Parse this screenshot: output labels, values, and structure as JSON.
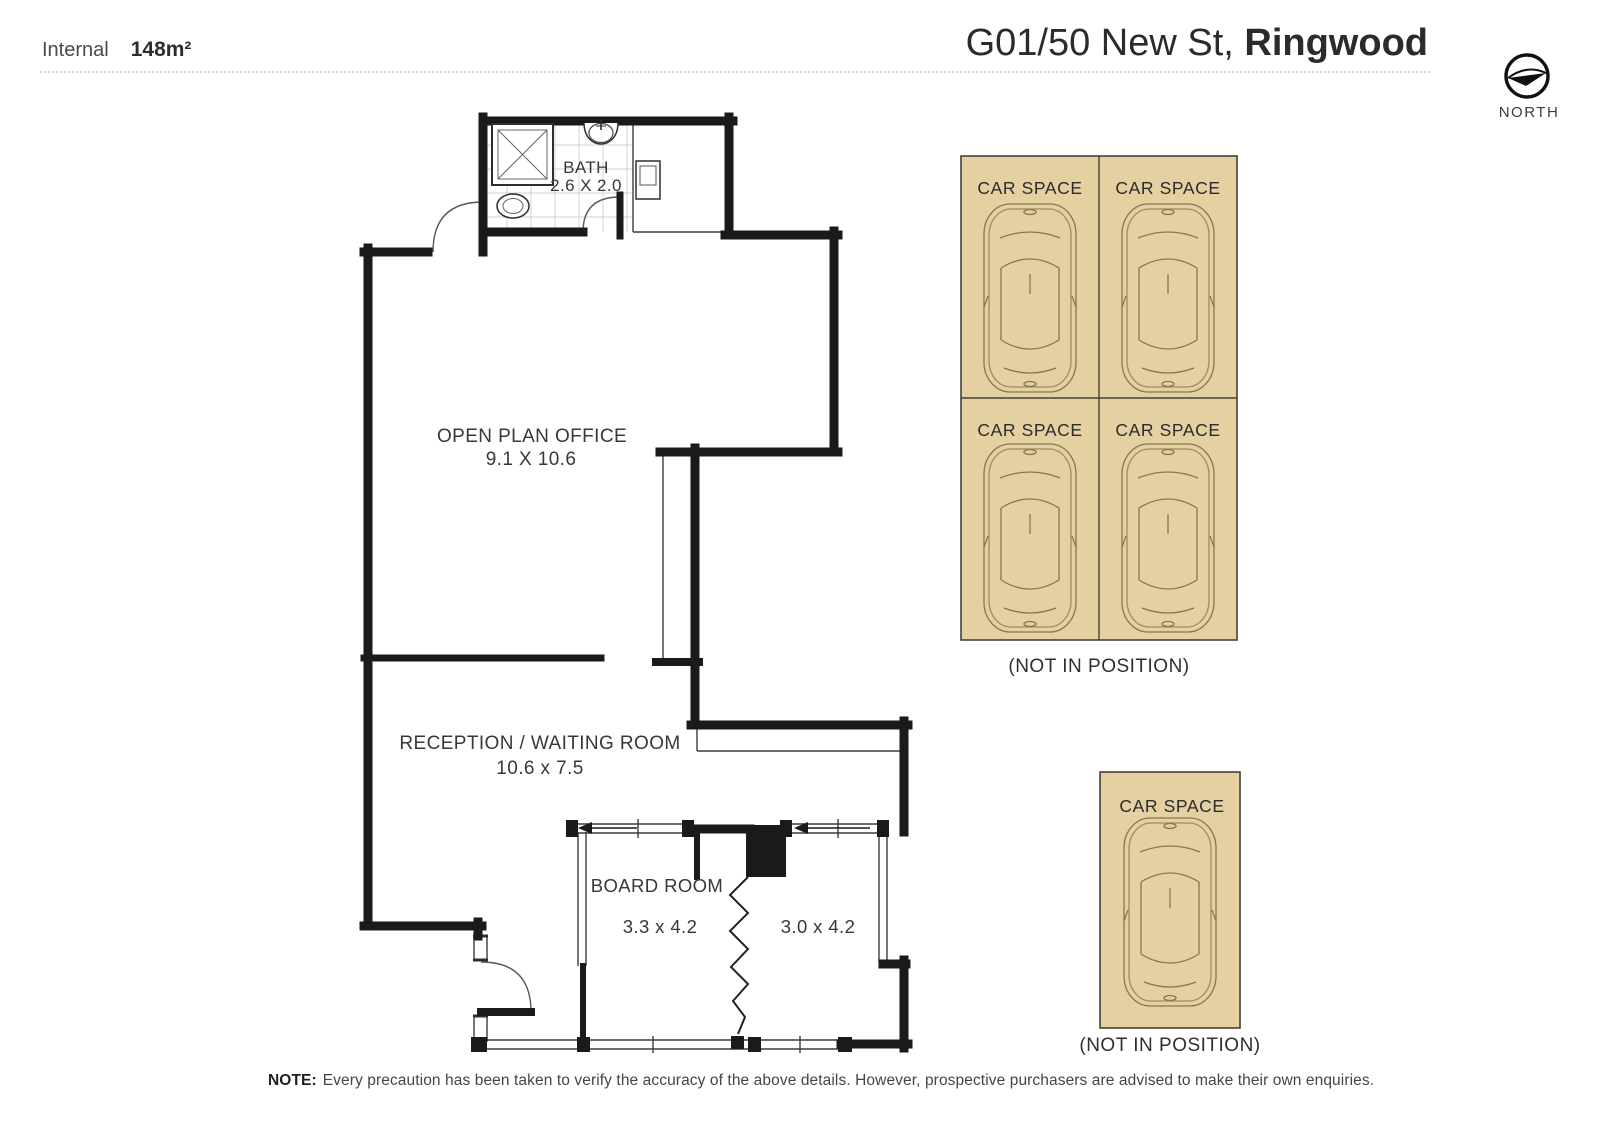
{
  "header": {
    "internal_label": "Internal",
    "internal_area": "148m²",
    "address_regular": "G01/50 New St, ",
    "address_bold": "Ringwood",
    "compass_label": "NORTH"
  },
  "plan": {
    "bath": {
      "name": "BATH",
      "dims": "2.6 X 2.0"
    },
    "open_plan_office": {
      "name": "OPEN PLAN OFFICE",
      "dims": "9.1 X 10.6"
    },
    "reception": {
      "name": "RECEPTION / WAITING ROOM",
      "dims": "10.6 x 7.5"
    },
    "board_room": {
      "name": "BOARD ROOM",
      "dims_left": "3.3 x 4.2",
      "dims_right": "3.0 x 4.2"
    }
  },
  "car_spaces": {
    "label": "CAR SPACE",
    "grid_count": 4,
    "single_count": 1,
    "grid_note": "(NOT IN POSITION)",
    "single_note": "(NOT IN POSITION)"
  },
  "footer": {
    "note_prefix": "NOTE:",
    "note_text": "Every precaution has been taken to verify the accuracy of the above details. However, prospective purchasers are advised to make their own enquiries."
  },
  "colors": {
    "wall": "#1a1a1a",
    "car_space_fill": "#e5d0a1",
    "car_space_border": "#45413a"
  }
}
